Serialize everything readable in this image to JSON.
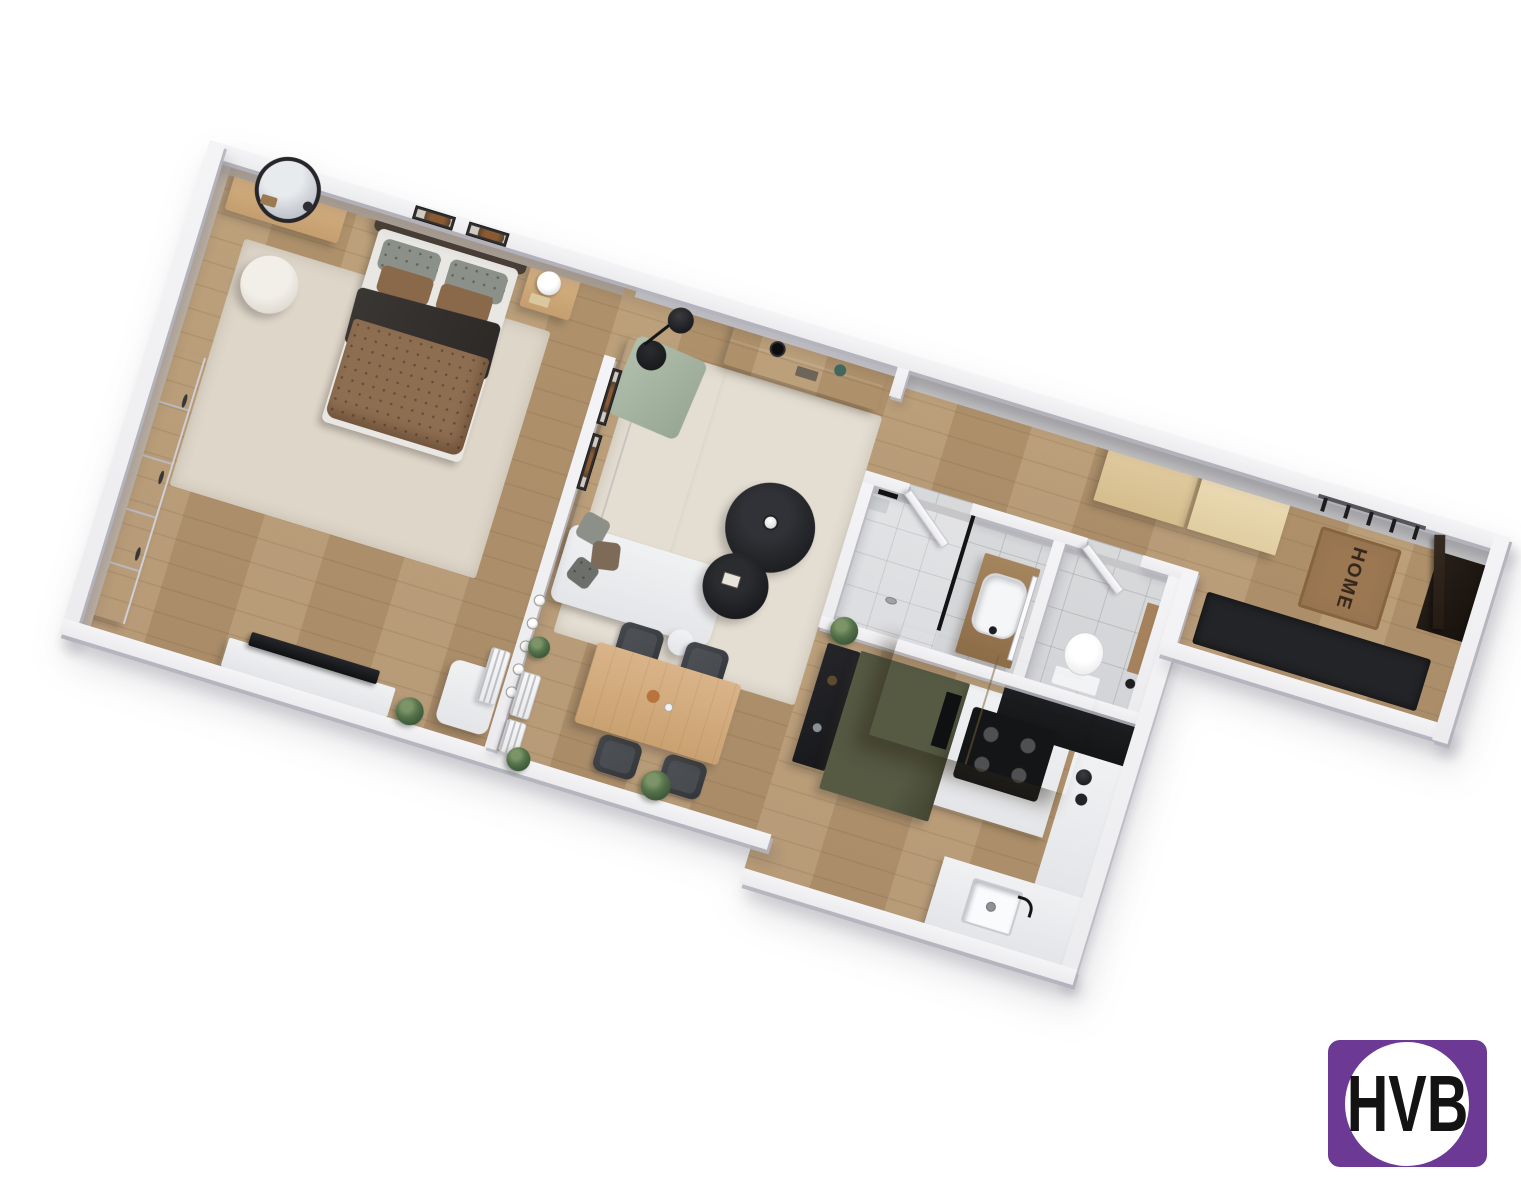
{
  "branding": {
    "logo_text": "HVB",
    "logo_background": "#6c3a95",
    "logo_circle": "#ffffff",
    "logo_text_color": "#131313"
  },
  "floor_plan": {
    "type": "3d-isometric-apartment-floor-plan",
    "doormat_text": "HOME",
    "rooms": [
      "bedroom",
      "living-room",
      "dining-area",
      "kitchen",
      "bathroom",
      "wc",
      "hallway",
      "entry"
    ],
    "furniture": {
      "bedroom": [
        "double-bed",
        "headboard",
        "pillows",
        "duvet",
        "dark-throw",
        "nightstand",
        "table-lamp",
        "vanity-desk",
        "round-mirror",
        "pouf",
        "wardrobe",
        "tv-bench",
        "tv",
        "armchair",
        "radiator",
        "area-rug",
        "wall-art-2-frames"
      ],
      "living_room": [
        "corner-sofa",
        "green-throw",
        "cushions",
        "round-coffee-tables-2",
        "media-console",
        "arc-floor-lamp",
        "side-table",
        "area-rug",
        "wall-art-2-frames"
      ],
      "dining_area": [
        "wood-dining-table",
        "chairs-4",
        "wall-bulb-lights",
        "radiators-2",
        "plants"
      ],
      "kitchen": [
        "olive-tall-unit",
        "oven",
        "induction-cooktop",
        "floating-beige-cabinet",
        "black-worktop",
        "white-counter",
        "sink",
        "faucet",
        "bar-shelf",
        "kettle",
        "plant"
      ],
      "bathroom": [
        "walk-in-shower",
        "glass-screen",
        "shower-drain",
        "wood-vanity",
        "basin",
        "mirror",
        "door",
        "towels"
      ],
      "wc": [
        "toilet",
        "wood-shelf",
        "door"
      ],
      "hallway_entry": [
        "beige-wardrobe",
        "coat-hooks-5",
        "home-doormat",
        "black-rug",
        "entry-door"
      ]
    },
    "palette": {
      "floor_wood": "#b79a73",
      "rug_cream": "#e0d9cc",
      "wall_white": "#f4f4f6",
      "wall_greige": "#b2a79a",
      "wall_grey": "#b5b4b6",
      "tile_grey": "#d8d9db",
      "kitchen_olive": "#51553f",
      "cabinet_beige": "#e3cfa4",
      "worktop_black": "#1a1b1d",
      "sofa_white": "#edeff1",
      "bed_brown": "#8e6e51",
      "throw_dark": "#343130",
      "throw_green": "#a8b6a3",
      "doormat_brown": "#9b7752",
      "rug_black": "#232427"
    }
  }
}
